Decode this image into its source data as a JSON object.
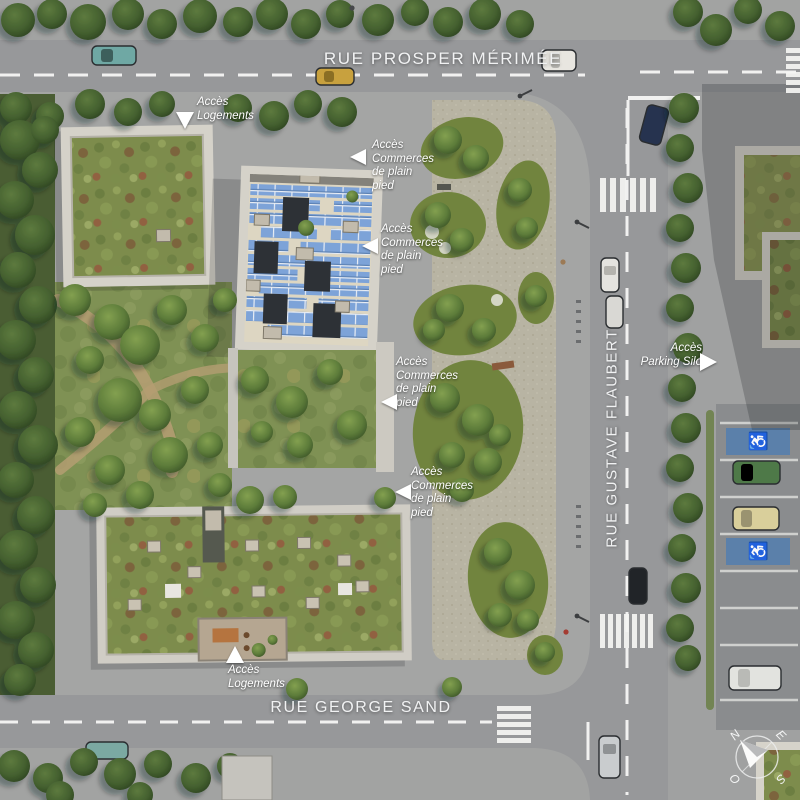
{
  "streets": {
    "top": "RUE PROSPER MÉRIMÉE",
    "right": "RUE GUSTAVE FLAUBERT",
    "bottom": "RUE GEORGE SAND"
  },
  "annotations": {
    "access_housing_top": "Accès\nLogements",
    "access_shops": "Accès\nCommerces\nde plain\npied",
    "access_parking_silo": "Accès\nParking Silo",
    "access_housing_bottom": "Accès\nLogements"
  },
  "compass": {
    "north": "N",
    "east": "E",
    "south": "S",
    "west": "O"
  },
  "parking": {
    "handicap_symbol": "♿"
  },
  "colors": {
    "road": "#97989a",
    "sidewalk": "#a4a5a4",
    "plaza_paving": "#b8b4a3",
    "park_grass": "#7f9154",
    "sedum_roof": "#7d8c4c",
    "solar_panel_blue": "#7da3d8",
    "concrete_frame": "#d3d0c8",
    "handicap_blue": "#5b80aa",
    "marking_white": "#ffffff"
  }
}
